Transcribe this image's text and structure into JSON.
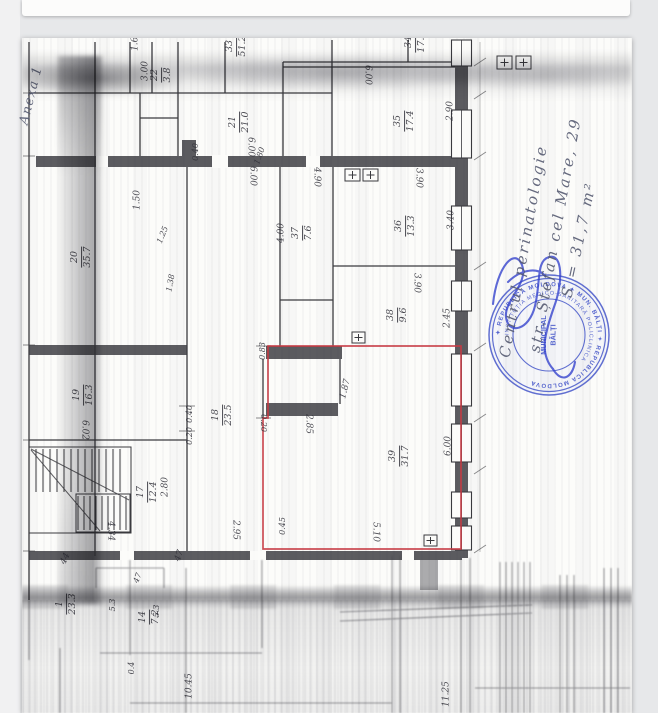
{
  "document": {
    "annex_note": "Anexa 1",
    "handwriting": {
      "line1": "Centrul perinatologie",
      "line2": "str. Ștefan cel Mare, 29",
      "line3": "S = 31,7 m²",
      "ink_color": "#565b72"
    }
  },
  "stamp": {
    "ring1": "✦ REPUBLICA MOLDOVA ✦ MUN. BĂLȚI ✦ REPUBLICA MOLDOVA",
    "ring2": "INSTITUȚIA MEDICO-SANITARĂ POLICLINICA",
    "center1": "MUNICIPAL",
    "center2": "BĂLȚI",
    "color": "#3b4dc7"
  },
  "plan": {
    "highlight_color": "#c63a42",
    "highlighted_room": {
      "number": "39",
      "area_m2": "31.7"
    },
    "room_labels": [
      {
        "n": "33",
        "d": "51.2",
        "x": 237,
        "y": 46,
        "r": -90
      },
      {
        "n": "34",
        "d": "17.1",
        "x": 416,
        "y": 42,
        "r": -90
      },
      {
        "n": "21",
        "d": "21.0",
        "x": 240,
        "y": 122,
        "r": -90
      },
      {
        "n": "22",
        "d": "3.8",
        "x": 162,
        "y": 75,
        "r": -90
      },
      {
        "n": "35",
        "d": "17.4",
        "x": 405,
        "y": 121,
        "r": -90
      },
      {
        "n": "20",
        "d": "35.7",
        "x": 82,
        "y": 257,
        "r": -90
      },
      {
        "n": "37",
        "d": "7.6",
        "x": 303,
        "y": 233,
        "r": -90
      },
      {
        "n": "36",
        "d": "13.3",
        "x": 406,
        "y": 226,
        "r": -90
      },
      {
        "n": "19",
        "d": "16.3",
        "x": 84,
        "y": 395,
        "r": -90
      },
      {
        "n": "18",
        "d": "23.5",
        "x": 223,
        "y": 415,
        "r": -90
      },
      {
        "n": "38",
        "d": "9.6",
        "x": 398,
        "y": 315,
        "r": -90
      },
      {
        "n": "39",
        "d": "31.7",
        "x": 400,
        "y": 456,
        "r": -90
      },
      {
        "n": "17",
        "d": "12.4",
        "x": 148,
        "y": 492,
        "r": -90
      },
      {
        "n": "1",
        "d": "23.3",
        "x": 67,
        "y": 604,
        "r": -90
      },
      {
        "n": "14",
        "d": "7.2",
        "x": 150,
        "y": 617,
        "r": -90
      }
    ],
    "dim_labels": [
      {
        "t": "1.60",
        "x": 136,
        "y": 41,
        "r": -90
      },
      {
        "t": "3.00",
        "x": 146,
        "y": 71,
        "r": -90
      },
      {
        "t": "1.50",
        "x": 138,
        "y": 200,
        "r": -90
      },
      {
        "t": "1.25",
        "x": 163,
        "y": 235,
        "r": -68,
        "s": 8
      },
      {
        "t": "1.38",
        "x": 171,
        "y": 283,
        "r": -80,
        "s": 8
      },
      {
        "t": "6.00",
        "x": 250,
        "y": 147,
        "r": 90
      },
      {
        "t": "6.00",
        "x": 252,
        "y": 176,
        "r": 90
      },
      {
        "t": "6.00",
        "x": 367,
        "y": 75,
        "r": 90
      },
      {
        "t": "2.90",
        "x": 451,
        "y": 111,
        "r": -90
      },
      {
        "t": "0.40",
        "x": 196,
        "y": 152,
        "r": -90,
        "s": 8
      },
      {
        "t": "1.80",
        "x": 260,
        "y": 156,
        "r": -70,
        "s": 8
      },
      {
        "t": "4.90",
        "x": 316,
        "y": 177,
        "r": 90
      },
      {
        "t": "4.00",
        "x": 282,
        "y": 233,
        "r": -90
      },
      {
        "t": "3.40",
        "x": 452,
        "y": 220,
        "r": -90
      },
      {
        "t": "3.90",
        "x": 418,
        "y": 178,
        "r": 90
      },
      {
        "t": "3.90",
        "x": 416,
        "y": 283,
        "r": 90
      },
      {
        "t": "2.45",
        "x": 448,
        "y": 318,
        "r": -90
      },
      {
        "t": "0.83",
        "x": 263,
        "y": 351,
        "r": -90,
        "s": 8
      },
      {
        "t": "1.87",
        "x": 346,
        "y": 389,
        "r": -76
      },
      {
        "t": "2.85",
        "x": 308,
        "y": 424,
        "r": 90
      },
      {
        "t": "0.20",
        "x": 263,
        "y": 423,
        "r": 90,
        "s": 8
      },
      {
        "t": "0.40",
        "x": 190,
        "y": 414,
        "r": -90,
        "s": 8
      },
      {
        "t": "0.20",
        "x": 190,
        "y": 436,
        "r": -90,
        "s": 8
      },
      {
        "t": "6.00",
        "x": 449,
        "y": 446,
        "r": -90
      },
      {
        "t": "5.10",
        "x": 375,
        "y": 532,
        "r": 90
      },
      {
        "t": "0.45",
        "x": 283,
        "y": 526,
        "r": -90,
        "s": 8
      },
      {
        "t": "6.02",
        "x": 84,
        "y": 430,
        "r": 90
      },
      {
        "t": "2.80",
        "x": 166,
        "y": 487,
        "r": -90
      },
      {
        "t": "4.34",
        "x": 110,
        "y": 531,
        "r": 90
      },
      {
        "t": "2.95",
        "x": 235,
        "y": 530,
        "r": 90
      },
      {
        "t": "44",
        "x": 66,
        "y": 559,
        "r": -65
      },
      {
        "t": "47",
        "x": 180,
        "y": 556,
        "r": -70
      },
      {
        "t": "47",
        "x": 138,
        "y": 578,
        "r": -70,
        "s": 8
      },
      {
        "t": "5.3",
        "x": 113,
        "y": 605,
        "r": -90,
        "s": 8
      },
      {
        "t": "5.3",
        "x": 157,
        "y": 611,
        "r": -90,
        "s": 8
      },
      {
        "t": "0.4",
        "x": 132,
        "y": 668,
        "r": -90,
        "s": 8
      },
      {
        "t": "10.45",
        "x": 190,
        "y": 686,
        "r": -90
      },
      {
        "t": "11.25",
        "x": 447,
        "y": 694,
        "r": -90
      }
    ]
  }
}
